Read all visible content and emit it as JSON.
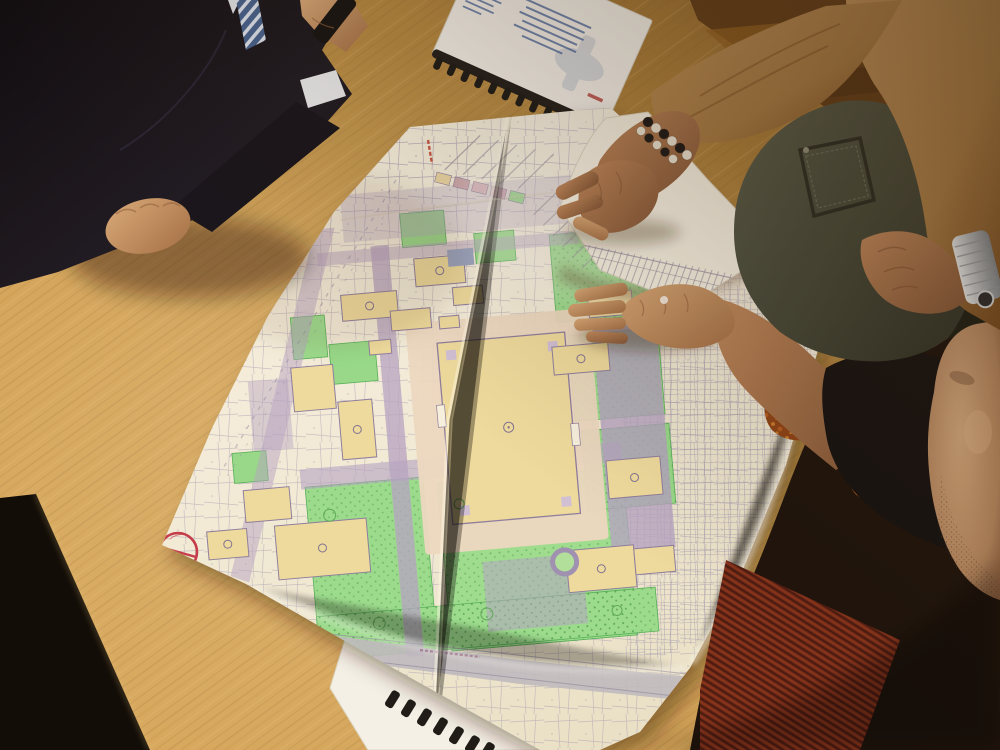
{
  "scene": {
    "description": "Overhead oblique photo: three people around a light oak table reviewing a large colored urban site plan; one hand grips the lifted top corner, another presses the sheet flat, a spiral-bound report lies beside the map.",
    "objects": [
      "site-plan-map",
      "spiral-report",
      "spiral-notebook-under-map",
      "steel-wristwatch",
      "bead-bracelet",
      "handheld-black-object"
    ]
  },
  "people": {
    "left": {
      "items": [
        "dark-suit",
        "striped-tie",
        "white-shirt-cuff",
        "closed-fist-on-table"
      ]
    },
    "right": {
      "items": [
        "camel-sweater",
        "bead-bracelet",
        "steel-watch",
        "dark-jeans-with-pocket"
      ]
    },
    "bottom": {
      "items": [
        "black-top",
        "bare-forearm-pressing-map",
        "stubbled-face"
      ]
    }
  },
  "table": {
    "material": "light oak",
    "base_color": "#c9994f",
    "grain_color": "#8a5c24"
  },
  "map": {
    "kind": "colored urban site / landscaping plan on a large folded sheet",
    "paper_color": "#f3eedd",
    "legend_swatches": [
      "#e9d6a6",
      "#c9a3ac",
      "#d6b1bd",
      "#c79fb4",
      "#90d489"
    ],
    "fills": {
      "building": "#eedc9f",
      "plaza": "#ecd9c4",
      "vegetation": "#97dc8e",
      "paving": "#b3a2c6",
      "road": "#bdb9c2",
      "linework": "#9a91b0"
    },
    "stamp": {
      "shape": "circle with needle",
      "color": "#c23648"
    },
    "flap_note": "top-right corner lifted, reverse side shows a printed column table"
  },
  "report": {
    "cover_color": "#f8f7f3",
    "binding_color": "#181818",
    "logo_color": "#4a7ec2",
    "text_color": "#3a5f9e",
    "accent_mark": "#b23333"
  },
  "notebook": {
    "binding_color": "#151515",
    "page_color": "#f5f3ec"
  },
  "lighting": {
    "bright_spot": "center-left of table",
    "shadow": "top-right and bottom-right corners"
  }
}
